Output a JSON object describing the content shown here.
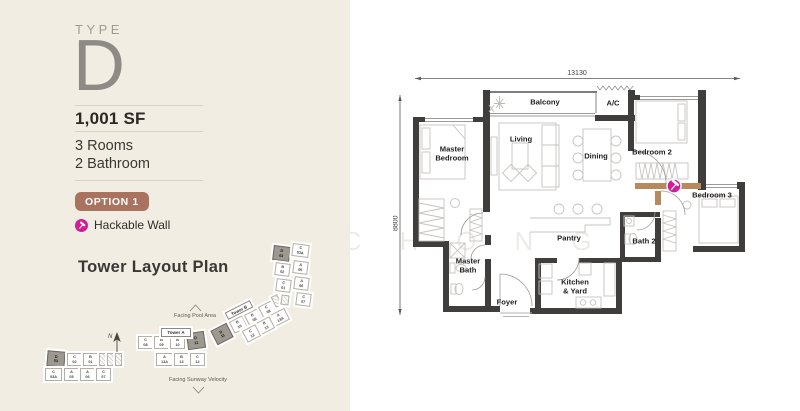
{
  "panel": {
    "type_label": "TYPE",
    "type_value": "D",
    "area": "1,001 SF",
    "rooms": "3 Rooms",
    "bathrooms": "2 Bathroom",
    "option_badge": "OPTION 1",
    "legend_label": "Hackable Wall",
    "tower_plan_title": "Tower Layout Plan"
  },
  "watermark": "ANNIE CHONG",
  "colors": {
    "panel_bg": "#f2ede3",
    "badge": "#a9735f",
    "hackable_icon": "#d11e96",
    "hackable_wall": "#b68a5e",
    "wall": "#3f3e3c"
  },
  "floor_plan": {
    "dim_width": "13130",
    "dim_height": "8800",
    "rooms": [
      {
        "id": "balcony",
        "name": "Balcony",
        "x": 152,
        "y": 40
      },
      {
        "id": "ac",
        "name": "A/C",
        "x": 220,
        "y": 41
      },
      {
        "id": "living",
        "name": "Living",
        "x": 128,
        "y": 77
      },
      {
        "id": "dining",
        "name": "Dining",
        "x": 203,
        "y": 94
      },
      {
        "id": "master-bedroom",
        "name": "Master\nBedroom",
        "x": 59,
        "y": 91
      },
      {
        "id": "bedroom-2",
        "name": "Bedroom 2",
        "x": 259,
        "y": 90
      },
      {
        "id": "bedroom-3",
        "name": "Bedroom 3",
        "x": 319,
        "y": 133
      },
      {
        "id": "pantry",
        "name": "Pantry",
        "x": 176,
        "y": 176
      },
      {
        "id": "bath-2",
        "name": "Bath 2",
        "x": 251,
        "y": 179
      },
      {
        "id": "master-bath",
        "name": "Master\nBath",
        "x": 75,
        "y": 203
      },
      {
        "id": "kitchen-yard",
        "name": "Kitchen\n& Yard",
        "x": 182,
        "y": 224
      },
      {
        "id": "foyer",
        "name": "Foyer",
        "x": 114,
        "y": 240
      }
    ]
  },
  "tower_layout": {
    "tower_a_label": "Tower A",
    "tower_b_label": "Tower B",
    "facing_top": "Facing Pool Area",
    "facing_bottom": "Facing Sunway Velocity",
    "north_label": "N",
    "units": [
      {
        "t": "C",
        "n": "08",
        "x": 128,
        "y": 96
      },
      {
        "t": "B",
        "n": "09",
        "x": 144,
        "y": 96
      },
      {
        "t": "B",
        "n": "10",
        "x": 160,
        "y": 96
      },
      {
        "t": "D",
        "n": "11",
        "x": 177,
        "y": 92,
        "w": 18,
        "h": 17,
        "r": -8,
        "dark": 1
      },
      {
        "t": "D",
        "n": "03",
        "x": 37,
        "y": 111,
        "w": 18,
        "h": 16,
        "r": 5,
        "dark": 1
      },
      {
        "t": "C",
        "n": "02",
        "x": 57,
        "y": 113
      },
      {
        "t": "B",
        "n": "01",
        "x": 73,
        "y": 113
      },
      {
        "core": 1,
        "x": 89,
        "y": 113,
        "w": 7,
        "h": 13
      },
      {
        "core": 1,
        "x": 97,
        "y": 113,
        "w": 7,
        "h": 13
      },
      {
        "core": 1,
        "x": 105,
        "y": 113,
        "w": 7,
        "h": 13
      },
      {
        "t": "A",
        "n": "13A",
        "x": 146,
        "y": 113,
        "w": 17
      },
      {
        "t": "B",
        "n": "13",
        "x": 164,
        "y": 113
      },
      {
        "t": "C",
        "n": "12",
        "x": 180,
        "y": 113
      },
      {
        "t": "C",
        "n": "03A",
        "x": 35,
        "y": 128,
        "w": 17
      },
      {
        "t": "A",
        "n": "05",
        "x": 54,
        "y": 128
      },
      {
        "t": "A",
        "n": "06",
        "x": 70,
        "y": 128
      },
      {
        "t": "C",
        "n": "07",
        "x": 86,
        "y": 128
      },
      {
        "t": "D",
        "n": "11",
        "x": 203,
        "y": 86,
        "w": 18,
        "h": 16,
        "r": -27,
        "dark": 1
      },
      {
        "t": "B",
        "n": "10",
        "x": 221,
        "y": 78,
        "r": -27
      },
      {
        "t": "B",
        "n": "09",
        "x": 236,
        "y": 71,
        "r": -27
      },
      {
        "t": "C",
        "n": "08",
        "x": 250,
        "y": 63,
        "r": -27
      },
      {
        "core": 1,
        "x": 263,
        "y": 55,
        "w": 7,
        "h": 12,
        "r": -27
      },
      {
        "t": "A",
        "n": "13A",
        "x": 261,
        "y": 71,
        "w": 17,
        "r": -27
      },
      {
        "t": "B",
        "n": "13",
        "x": 248,
        "y": 79,
        "r": -27
      },
      {
        "t": "C",
        "n": "12",
        "x": 234,
        "y": 87,
        "r": -27
      },
      {
        "t": "D",
        "n": "03",
        "x": 263,
        "y": 6,
        "w": 17,
        "h": 15,
        "r": 7,
        "dark": 1
      },
      {
        "t": "C",
        "n": "03A",
        "x": 282,
        "y": 4,
        "w": 17,
        "r": 7
      },
      {
        "t": "B",
        "n": "02",
        "x": 265,
        "y": 23,
        "r": 7
      },
      {
        "t": "A",
        "n": "05",
        "x": 283,
        "y": 21,
        "r": 7
      },
      {
        "t": "C",
        "n": "01",
        "x": 266,
        "y": 39,
        "r": 7
      },
      {
        "t": "A",
        "n": "06",
        "x": 284,
        "y": 37,
        "r": 7
      },
      {
        "t": "C",
        "n": "07",
        "x": 286,
        "y": 53,
        "r": 7
      },
      {
        "core": 1,
        "x": 271,
        "y": 55,
        "w": 8,
        "h": 10,
        "r": 7
      }
    ]
  }
}
